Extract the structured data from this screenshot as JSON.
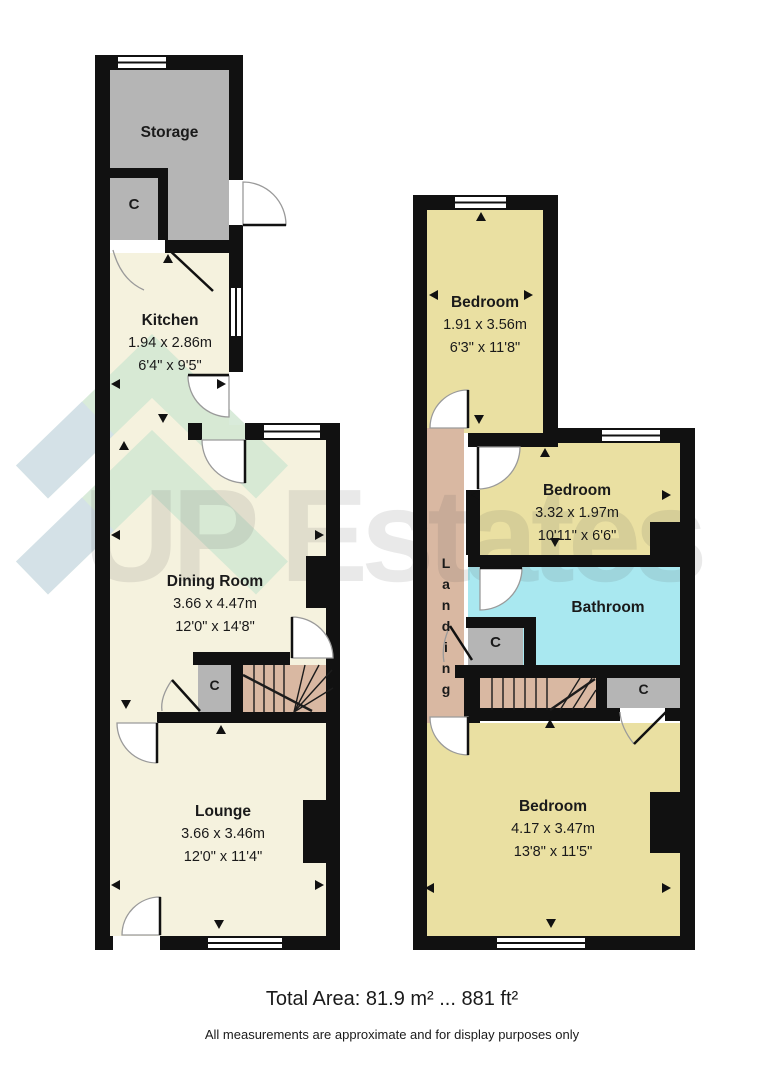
{
  "watermark": {
    "text": "UP Estates"
  },
  "rooms": {
    "storage": {
      "name": "Storage"
    },
    "kitchen": {
      "name": "Kitchen",
      "metric": "1.94 x 2.86m",
      "imperial": "6'4\" x 9'5\""
    },
    "dining_room": {
      "name": "Dining Room",
      "metric": "3.66 x 4.47m",
      "imperial": "12'0\" x 14'8\""
    },
    "lounge": {
      "name": "Lounge",
      "metric": "3.66 x 3.46m",
      "imperial": "12'0\" x 11'4\""
    },
    "bedroom_top": {
      "name": "Bedroom",
      "metric": "1.91 x 3.56m",
      "imperial": "6'3\" x 11'8\""
    },
    "bedroom_middle": {
      "name": "Bedroom",
      "metric": "3.32 x 1.97m",
      "imperial": "10'11\" x 6'6\""
    },
    "bathroom": {
      "name": "Bathroom"
    },
    "landing": {
      "name": "Landing"
    },
    "bedroom_main": {
      "name": "Bedroom",
      "metric": "4.17 x 3.47m",
      "imperial": "13'8\" x 11'5\""
    }
  },
  "closet_label": "C",
  "footer": {
    "total_area": "Total Area: 81.9 m² ... 881 ft²",
    "disclaimer": "All measurements are approximate and for display purposes only"
  },
  "colors": {
    "wall": "#111111",
    "ground_floor_room": "#f5f2de",
    "bedroom_yellow": "#eae0a2",
    "landing_tan": "#d9b8a2",
    "bathroom_cyan": "#a9e8f0",
    "closet_gray": "#b5b5b5",
    "logo_green": "#cfe6d1",
    "logo_blue": "#d2deea"
  }
}
